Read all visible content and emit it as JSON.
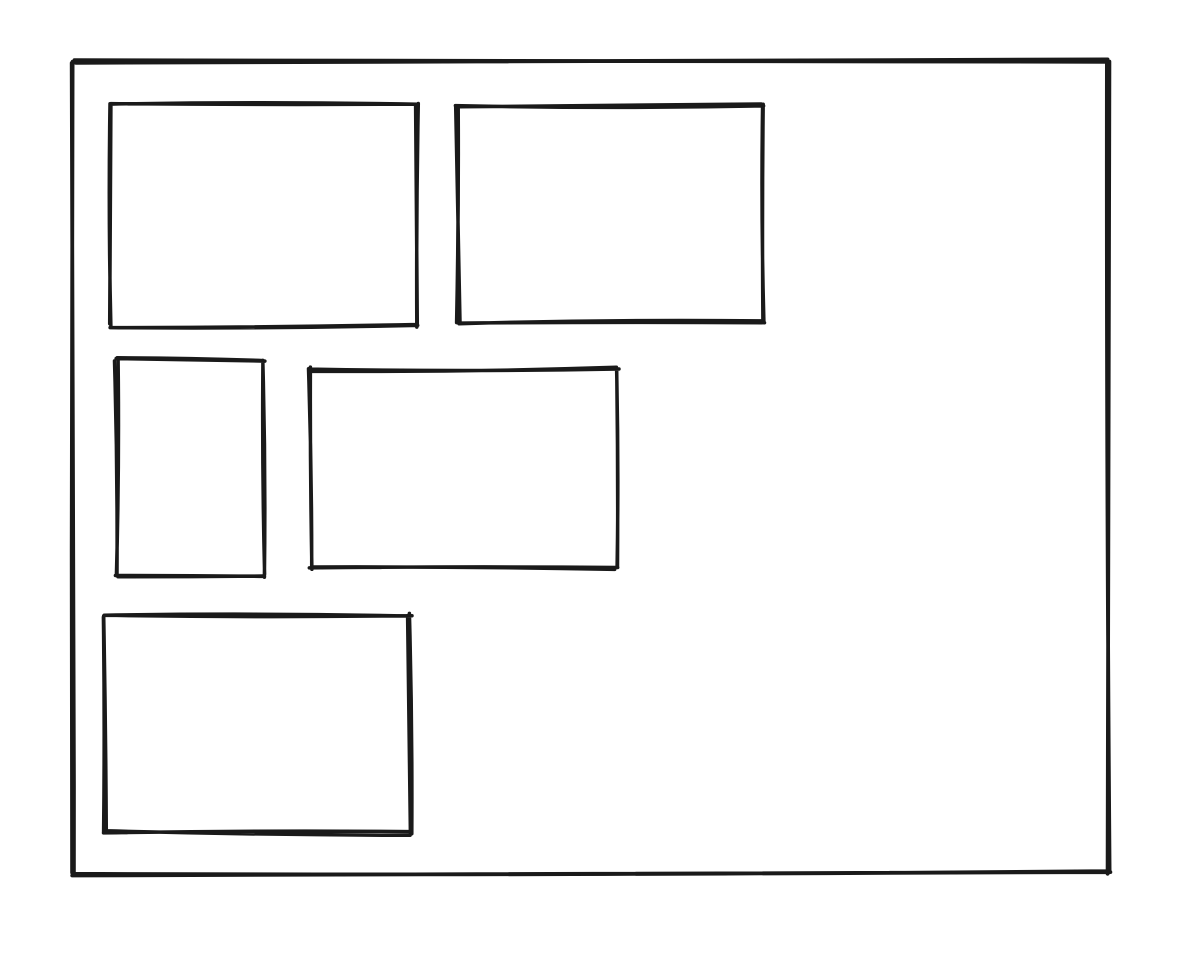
{
  "canvas": {
    "width": 1192,
    "height": 956,
    "background": "#ffffff"
  },
  "drawing": {
    "stroke_color": "#1a1a1a",
    "stroke_width": 3.5,
    "shapes": [
      {
        "id": "outer-frame",
        "type": "rectangle",
        "x": 73,
        "y": 61,
        "width": 1036,
        "height": 812,
        "stroke_width": 3.8,
        "seed": 7
      },
      {
        "id": "rect-top-left",
        "type": "rectangle",
        "x": 111,
        "y": 104,
        "width": 306,
        "height": 222,
        "stroke_width": 3.5,
        "seed": 11
      },
      {
        "id": "rect-top-right",
        "type": "rectangle",
        "x": 458,
        "y": 106,
        "width": 305,
        "height": 216,
        "stroke_width": 3.5,
        "seed": 23
      },
      {
        "id": "rect-middle-left",
        "type": "rectangle",
        "x": 117,
        "y": 360,
        "width": 146,
        "height": 216,
        "stroke_width": 3.5,
        "seed": 31
      },
      {
        "id": "rect-middle-center",
        "type": "rectangle",
        "x": 311,
        "y": 369,
        "width": 306,
        "height": 199,
        "stroke_width": 3.5,
        "seed": 41
      },
      {
        "id": "rect-bottom-left",
        "type": "rectangle",
        "x": 104,
        "y": 615,
        "width": 306,
        "height": 218,
        "stroke_width": 3.5,
        "seed": 53
      }
    ]
  }
}
